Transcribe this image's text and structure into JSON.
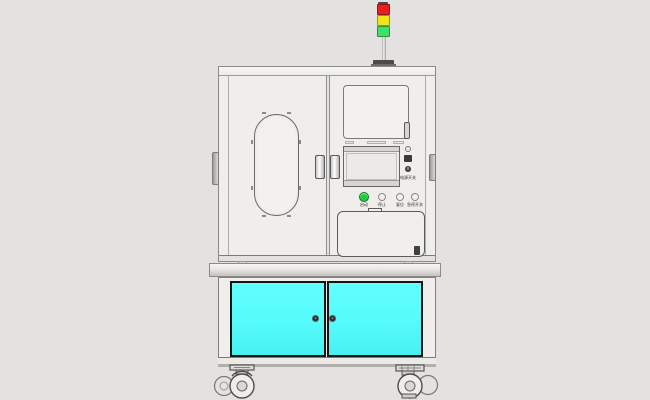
{
  "meta": {
    "title": "Automated test equipment cabinet – front-view CAD rendering",
    "view": "front elevation line drawing on light gray background"
  },
  "colors": {
    "background": "#E4E2E0",
    "machine_body": "#F0EEEB",
    "outline_gray": "#8A8A8A",
    "cabinet_door_cyan": "#55FBFB",
    "tower_red": "#E62020",
    "tower_yellow": "#F2E41C",
    "tower_green": "#3FE06A",
    "start_button_green": "#1FCC3F",
    "knob_dark": "#2C2C2C"
  },
  "tower_light": {
    "name": "three-color signal tower on pole",
    "segments": [
      {
        "name": "red",
        "hex": "#E62020"
      },
      {
        "name": "yellow",
        "hex": "#F2E41C"
      },
      {
        "name": "green",
        "hex": "#3FE06A"
      }
    ]
  },
  "upper_enclosure": {
    "left_door": {
      "window": "rounded oval viewing window with retaining clips"
    },
    "right_panel": {
      "top_window": "rectangular viewing window with pull handle",
      "monitor": "flat display with top and bottom bezel strips",
      "side_controls": {
        "items": [
          "indicator lamp",
          "connector port",
          "key switch"
        ],
        "label": "电源开关"
      },
      "buttons": [
        {
          "label": "启动",
          "style": "filled-green"
        },
        {
          "label": "停止",
          "style": "outline"
        },
        {
          "label": "复位",
          "style": "outline"
        },
        {
          "label": "急停开关",
          "style": "outline"
        }
      ],
      "drawer": "access tray with top tab and bottom-right latch"
    }
  },
  "lower_cabinet": {
    "doors": [
      {
        "name": "left cyan door with round knob"
      },
      {
        "name": "right cyan door with round knob"
      }
    ],
    "door_color": "#55FBFB"
  },
  "base": {
    "casters": [
      "left swivel caster",
      "right swivel caster"
    ]
  }
}
